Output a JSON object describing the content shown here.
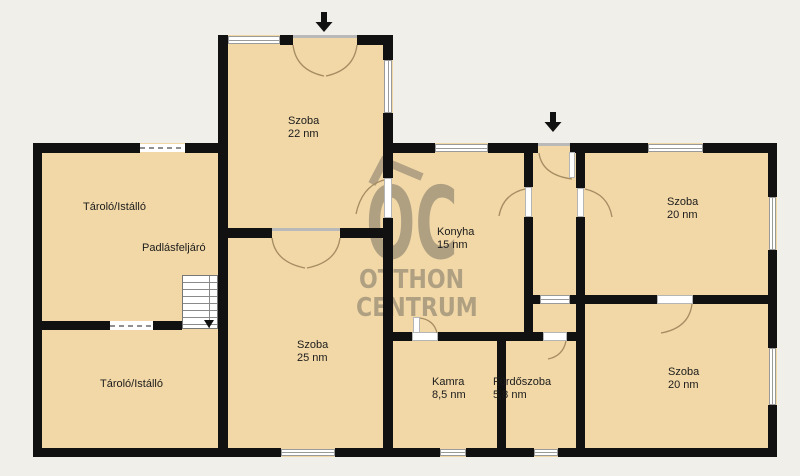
{
  "meta": {
    "type": "floor-plan"
  },
  "colors": {
    "background": "#f1efe9",
    "floor": "#f2d8a7",
    "wall": "#111111",
    "window": "#ffffff",
    "window_border": "#9a9a9a",
    "door_arc": "#a58c62",
    "label": "#1b1b1b",
    "watermark": "#887e6d"
  },
  "rooms": [
    {
      "name": "Szoba",
      "area": "22 nm"
    },
    {
      "name": "Tároló/Istálló",
      "area": ""
    },
    {
      "name": "Padlásfeljáró",
      "area": ""
    },
    {
      "name": "Tároló/Istálló",
      "area": ""
    },
    {
      "name": "Szoba",
      "area": "25 nm"
    },
    {
      "name": "Konyha",
      "area": "15 nm"
    },
    {
      "name": "Szoba",
      "area": "20 nm"
    },
    {
      "name": "Kamra",
      "area": "8,5 nm"
    },
    {
      "name": "Fürdőszoba",
      "area": "5,8 nm"
    },
    {
      "name": "Szoba",
      "area": "20 nm"
    }
  ],
  "watermark": {
    "logo": "OC",
    "line1": "OTTHON",
    "line2": "CENTRUM"
  }
}
